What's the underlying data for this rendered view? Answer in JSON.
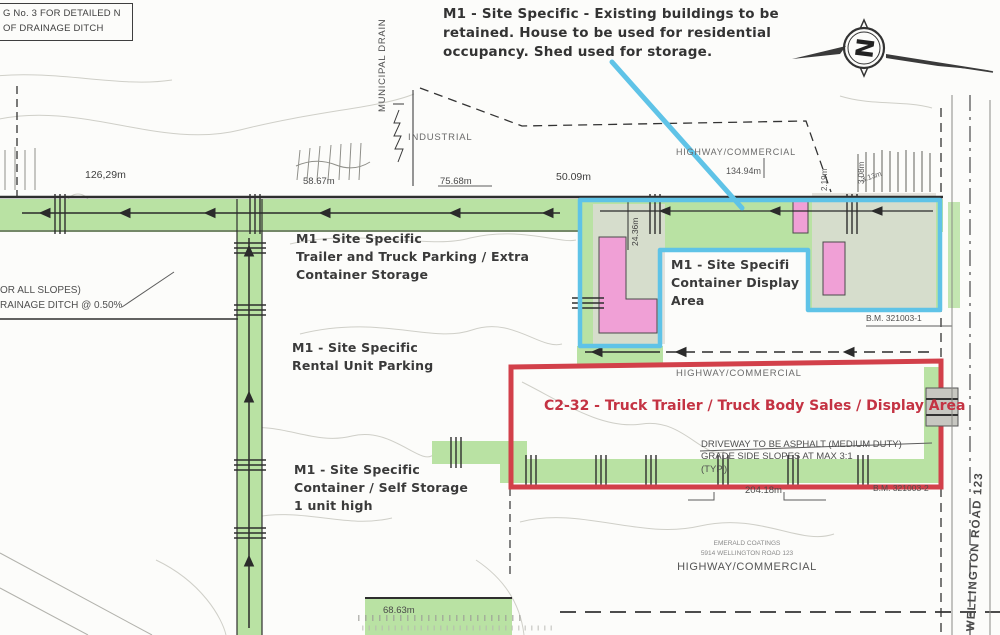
{
  "notes": {
    "detail_box": {
      "line1": "G No. 3 FOR DETAILED",
      "line2": "N OF DRAINAGE DITCH"
    },
    "existing_buildings": {
      "line1": "M1 - Site Specific - Existing buildings to be",
      "line2": "retained.  House to be used for residential",
      "line3": "occupancy.  Shed used for storage."
    },
    "slopes": {
      "line1": "OR ALL SLOPES)",
      "line2": "RAINAGE DITCH @ 0.50%"
    },
    "driveway": {
      "line1": "DRIVEWAY TO BE ASPHALT (MEDIUM DUTY)",
      "line2": "GRADE SIDE SLOPES AT MAX 3:1",
      "line3": "(TYP.)"
    }
  },
  "zones": {
    "trailer_parking": {
      "line1": "M1 - Site Specific",
      "line2": "Trailer and Truck Parking / Extra",
      "line3": "Container Storage"
    },
    "container_display": {
      "line1": "M1 - Site Specifi",
      "line2": "Container Display",
      "line3": "Area"
    },
    "rental_unit": {
      "line1": "M1 - Site Specific",
      "line2": "Rental Unit Parking"
    },
    "self_storage": {
      "line1": "M1 - Site Specific",
      "line2": "Container / Self Storage",
      "line3": "1 unit high"
    },
    "c2_32": "C2-32 - Truck Trailer / Truck Body Sales / Display Area"
  },
  "labels": {
    "municipal_drain": "MUNICIPAL DRAIN",
    "industrial": "INDUSTRIAL",
    "highway_commercial_top": "HIGHWAY/COMMERCIAL",
    "highway_commercial_mid": "HIGHWAY/COMMERCIAL",
    "wellington_road": "WELLINGTON ROAD 123",
    "emerald_line1": "EMERALD COATINGS",
    "emerald_line2": "5914 WELLINGTON ROAD 123",
    "emerald_line3": "HIGHWAY/COMMERCIAL",
    "north": "N"
  },
  "measurements": {
    "top_left": "126,29m",
    "top_2": "58.67m",
    "top_3": "75.68m",
    "top_4": "50.09m",
    "top_5": "134.94m",
    "v_1": "2.19m",
    "v_2": "3.08m",
    "v_3": "3.13m",
    "v_4": "24.36m",
    "bottom_red": "204.18m",
    "bottom_left": "68.63m"
  },
  "benchmarks": {
    "bm_1": "B.M. 321003-1",
    "bm_2": "B.M. 321003-2"
  },
  "colors": {
    "landscape_green": "#b9e2a3",
    "building_pink": "#f0a0d6",
    "display_outline_cyan": "#5fc3e7",
    "c2_outline_red": "#d2404a"
  }
}
